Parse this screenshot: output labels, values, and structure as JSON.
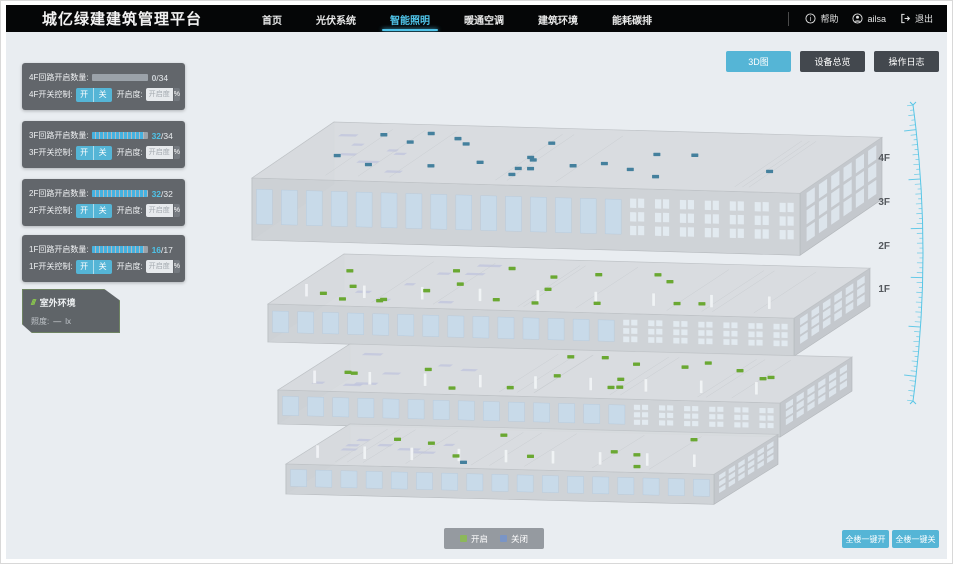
{
  "header": {
    "title": "城亿绿建建筑管理平台",
    "nav": [
      {
        "label": "首页",
        "active": false
      },
      {
        "label": "光伏系统",
        "active": false
      },
      {
        "label": "智能照明",
        "active": true
      },
      {
        "label": "暖通空调",
        "active": false
      },
      {
        "label": "建筑环境",
        "active": false
      },
      {
        "label": "能耗碳排",
        "active": false
      }
    ],
    "help_label": "帮助",
    "username": "ailsa",
    "logout_label": "退出"
  },
  "view_buttons": [
    {
      "label": "3D图",
      "active": true
    },
    {
      "label": "设备总览",
      "active": false
    },
    {
      "label": "操作日志",
      "active": false
    }
  ],
  "floor_panels": [
    {
      "floor": "4F",
      "circuit_label": "4F回路开启数量:",
      "open": 0,
      "total": 34,
      "count_open": "0",
      "count_total": "/34",
      "open_color": "#ccd2d7",
      "switch_label": "4F开关控制:",
      "on_label": "开",
      "off_label": "关",
      "dim_label": "开启度:",
      "dim_placeholder": "开启度",
      "percent_label": "%"
    },
    {
      "floor": "3F",
      "circuit_label": "3F回路开启数量:",
      "open": 32,
      "total": 34,
      "count_open": "32",
      "count_total": "/34",
      "open_color": "#4fc3e8",
      "switch_label": "3F开关控制:",
      "on_label": "开",
      "off_label": "关",
      "dim_label": "开启度:",
      "dim_placeholder": "开启度",
      "percent_label": "%"
    },
    {
      "floor": "2F",
      "circuit_label": "2F回路开启数量:",
      "open": 32,
      "total": 32,
      "count_open": "32",
      "count_total": "/32",
      "open_color": "#4fc3e8",
      "switch_label": "2F开关控制:",
      "on_label": "开",
      "off_label": "关",
      "dim_label": "开启度:",
      "dim_placeholder": "开启度",
      "percent_label": "%"
    },
    {
      "floor": "1F",
      "circuit_label": "1F回路开启数量:",
      "open": 16,
      "total": 17,
      "count_open": "16",
      "count_total": "/17",
      "open_color": "#4fc3e8",
      "switch_label": "1F开关控制:",
      "on_label": "开",
      "off_label": "关",
      "dim_label": "开启度:",
      "dim_placeholder": "开启度",
      "percent_label": "%"
    }
  ],
  "outdoor_panel": {
    "icon": "///",
    "title": "室外环境",
    "illuminance_label": "照度:",
    "illuminance_value": "—",
    "illuminance_unit": "lx"
  },
  "legend": {
    "on_label": "开启",
    "off_label": "关闭",
    "on_color": "#8cb85a",
    "off_color": "#7a95c6"
  },
  "bottom_buttons": [
    {
      "label": "全楼一键开"
    },
    {
      "label": "全楼一键关"
    }
  ],
  "floor_scale": {
    "labels": [
      "4F",
      "3F",
      "2F",
      "1F"
    ]
  },
  "building": {
    "floors": [
      {
        "name": "4F",
        "on_markers": 0,
        "off_markers": 22
      },
      {
        "name": "3F",
        "on_markers": 20,
        "off_markers": 0
      },
      {
        "name": "2F",
        "on_markers": 17,
        "off_markers": 0
      },
      {
        "name": "1F",
        "on_markers": 9,
        "off_markers": 1
      }
    ],
    "marker_on_color": "#6aa832",
    "marker_off_color": "#44809d"
  },
  "colors": {
    "accent": "#55b5d6",
    "nav_active": "#4fc3e8",
    "progress": "#45b2e0",
    "scale": "#58c6e6"
  }
}
